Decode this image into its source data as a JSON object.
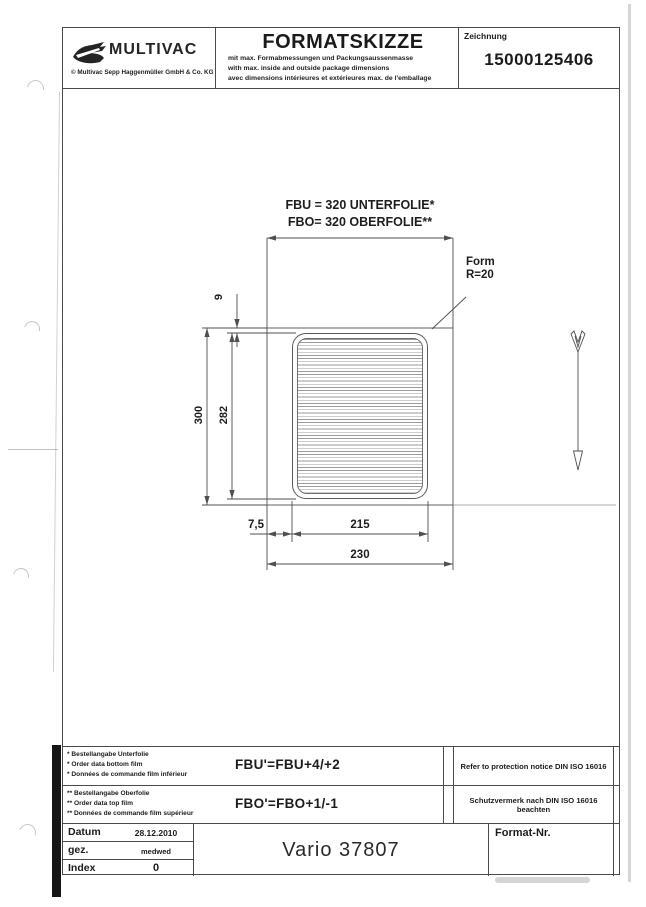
{
  "header": {
    "logo_text": "MULTIVAC",
    "logo_copyright": "© Multivac Sepp Haggenmüller GmbH & Co. KG",
    "title": "FORMATSKIZZE",
    "subtitle_de": "mit max. Formabmessungen und Packungsaussenmasse",
    "subtitle_en": "with max. inside and outside package dimensions",
    "subtitle_fr": "avec dimensions intérieures et extérieures max. de l'emballage",
    "drawing_label": "Zeichnung",
    "drawing_number": "15000125406"
  },
  "drawing": {
    "dim_top_bottom_film": "FBU = 320 UNTERFOLIE*",
    "dim_top_top_film": "FBO= 320 OBERFOLIE**",
    "form_note_line1": "Form",
    "form_note_line2": "R=20",
    "dim_9": "9",
    "dim_300": "300",
    "dim_282": "282",
    "dim_7_5": "7,5",
    "dim_215": "215",
    "dim_230": "230"
  },
  "footer": {
    "row_bottom_film": {
      "line1": "* Bestellangabe Unterfolie",
      "line2": "* Order data bottom film",
      "line3": "* Données de commande film inférieur",
      "formula": "FBU'=FBU+4/+2",
      "notice": "Refer to protection notice DIN ISO 16016"
    },
    "row_top_film": {
      "line1": "** Bestellangabe Oberfolie",
      "line2": "** Order data top film",
      "line3": "** Données de commande film supérieur",
      "formula": "FBO'=FBO+1/-1",
      "notice": "Schutzvermerk nach DIN ISO 16016 beachten"
    }
  },
  "title_block": {
    "rows": [
      {
        "label": "Datum",
        "value": "28.12.2010"
      },
      {
        "label": "gez.",
        "value": "medwed"
      },
      {
        "label": "Index",
        "value": "0"
      }
    ],
    "machine": "Vario 37807",
    "format_label": "Format-Nr."
  }
}
